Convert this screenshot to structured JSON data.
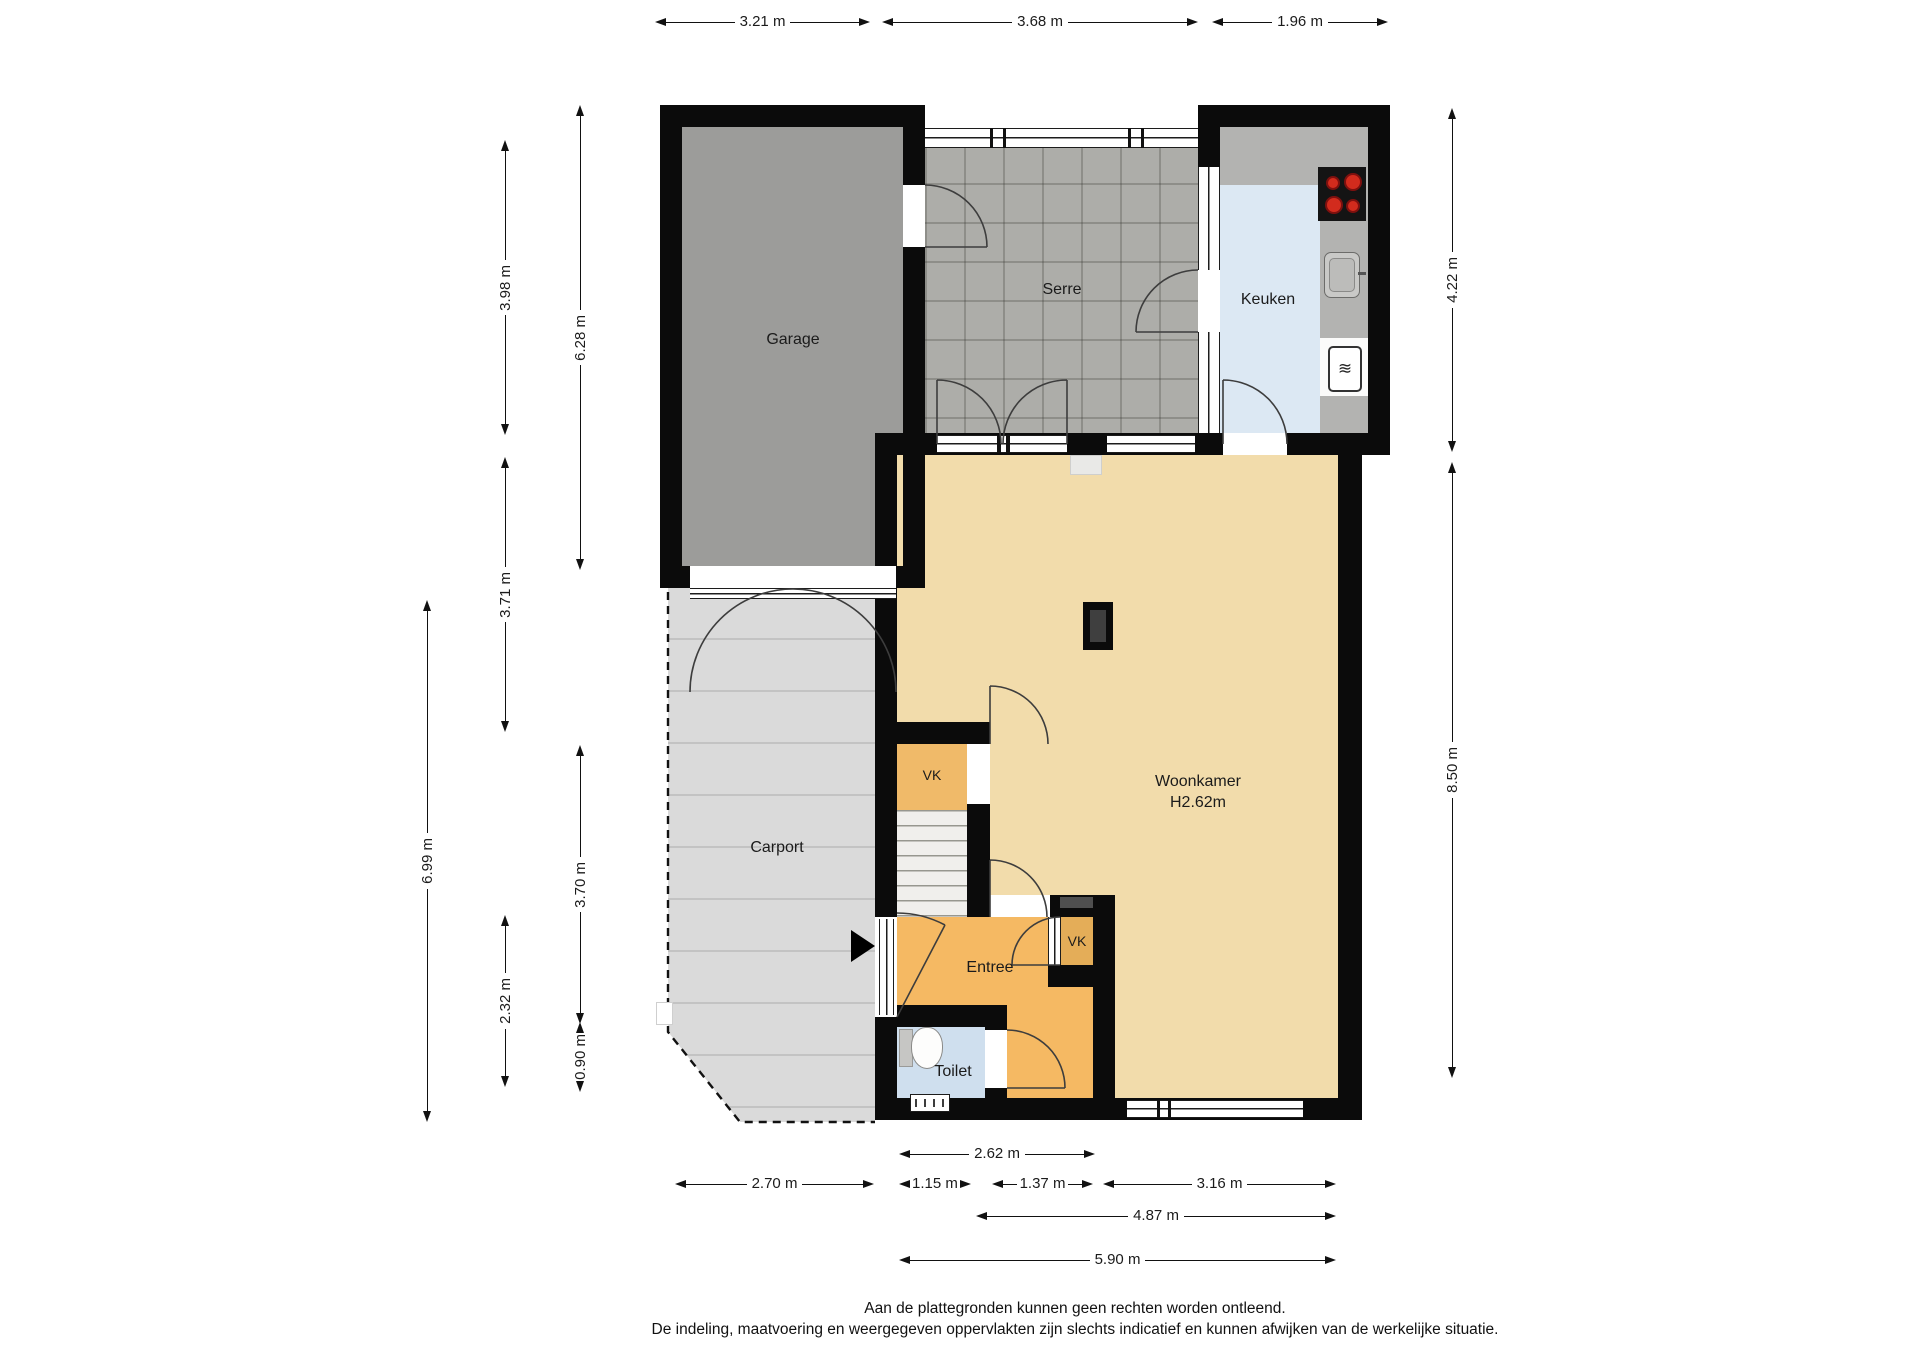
{
  "plan": {
    "rooms": {
      "garage": "Garage",
      "serre": "Serre",
      "keuken": "Keuken",
      "woonkamer": "Woonkamer",
      "woonkamer_height": "H2.62m",
      "carport": "Carport",
      "entree": "Entree",
      "toilet": "Toilet",
      "vk_upper": "VK",
      "vk_lower": "VK"
    },
    "dimensions": {
      "top": [
        "3.21 m",
        "3.68 m",
        "1.96 m"
      ],
      "left": [
        "3.98 m",
        "6.28 m",
        "3.71 m",
        "6.99 m",
        "3.70 m",
        "2.32 m",
        "0.90 m"
      ],
      "right": [
        "4.22 m",
        "8.50 m"
      ],
      "bottom": [
        "2.62 m",
        "2.70 m",
        "1.15 m",
        "1.37 m",
        "3.16 m",
        "4.87 m",
        "5.90 m"
      ]
    },
    "footer": {
      "line1": "Aan de plattegronden kunnen geen rechten worden ontleend.",
      "line2": "De indeling, maatvoering en weergegeven oppervlakten zijn slechts indicatief en kunnen afwijken van de werkelijke situatie."
    },
    "colors": {
      "wall": "#0b0b0b",
      "garage_floor": "#9c9c9a",
      "serre_floor": "#adada9",
      "keuken_floor": "#dce8f3",
      "counter": "#b3b3b1",
      "woonkamer_floor": "#f2dcab",
      "entree_floor": "#f5b963",
      "vk_lower_floor": "#e4ad58",
      "toilet_floor": "#cfdfee",
      "carport_floor": "#dadada",
      "burner_red": "#d22b1d"
    }
  }
}
